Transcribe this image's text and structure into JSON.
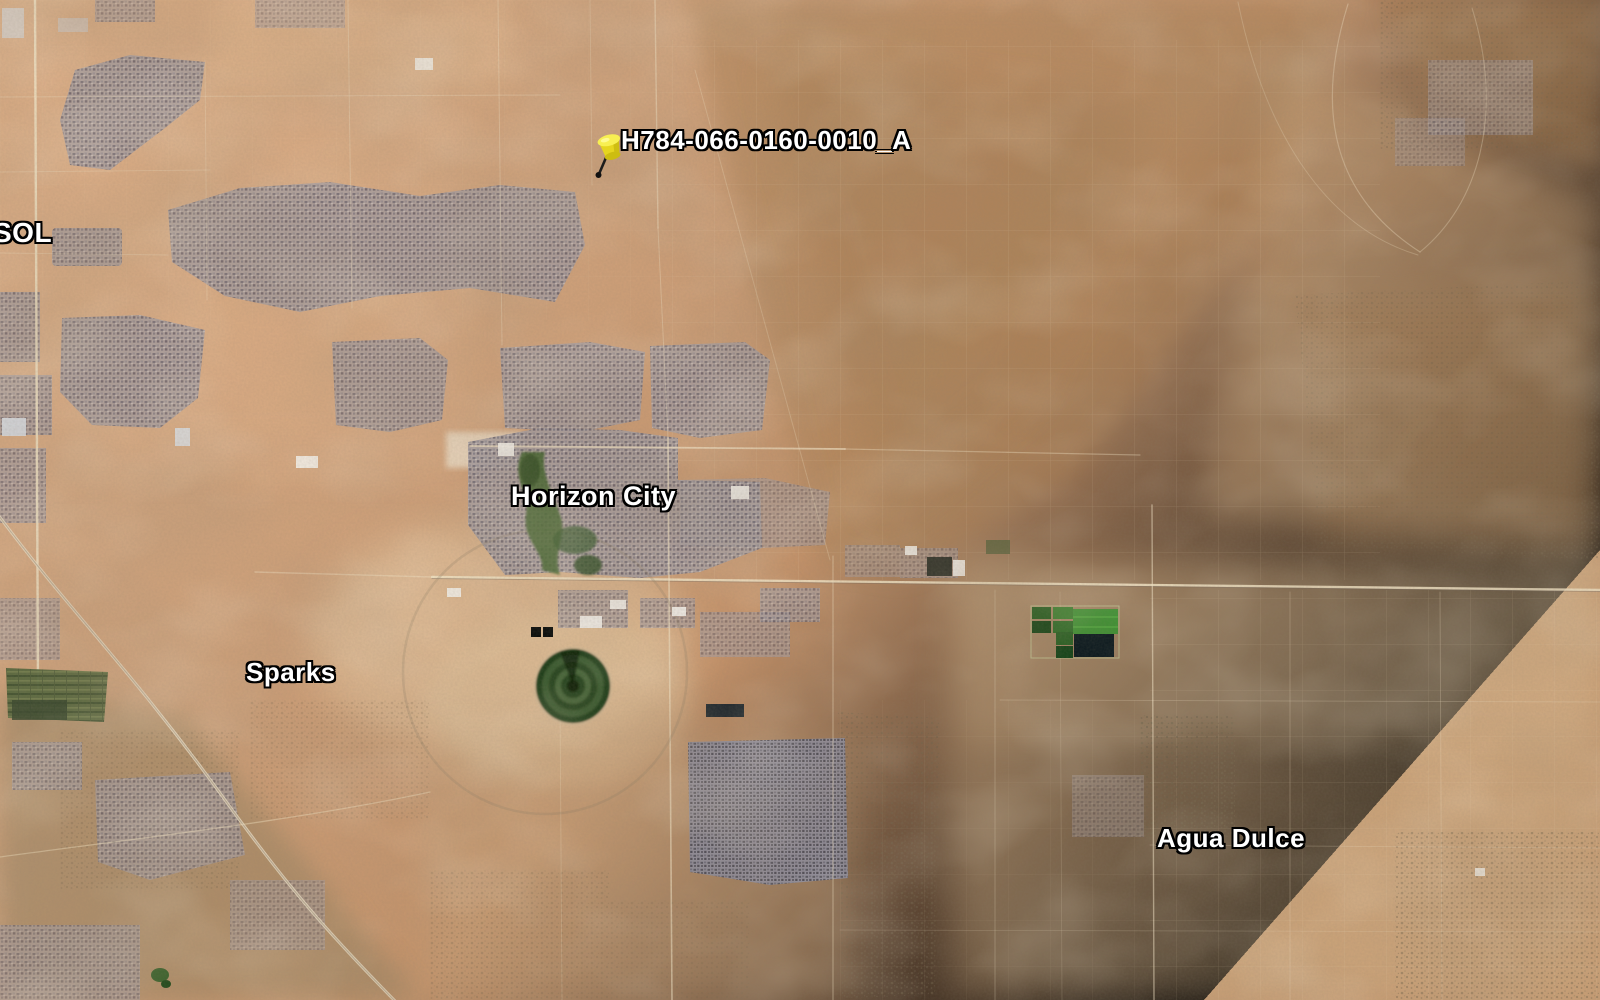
{
  "place_labels": {
    "left_edge_partial": "SOL",
    "horizon_city": "Horizon City",
    "sparks": "Sparks",
    "agua_dulce": "Agua Dulce"
  },
  "placemark": {
    "label": "H784-066-0160-0010_A",
    "pin": "yellow-pushpin-icon"
  },
  "imagery": {
    "type": "satellite",
    "colors": {
      "desert_base": "#C99A73",
      "desert_light": "#E2C49E",
      "desert_dark": "#A87F55",
      "urban_gray": "#827D88",
      "vegetation_green": "#3F7A2E",
      "dark_field": "#0D1A20",
      "pin_yellow": "#F2E31F",
      "label_text": "#FFFFFF",
      "label_outline": "#000000"
    }
  }
}
